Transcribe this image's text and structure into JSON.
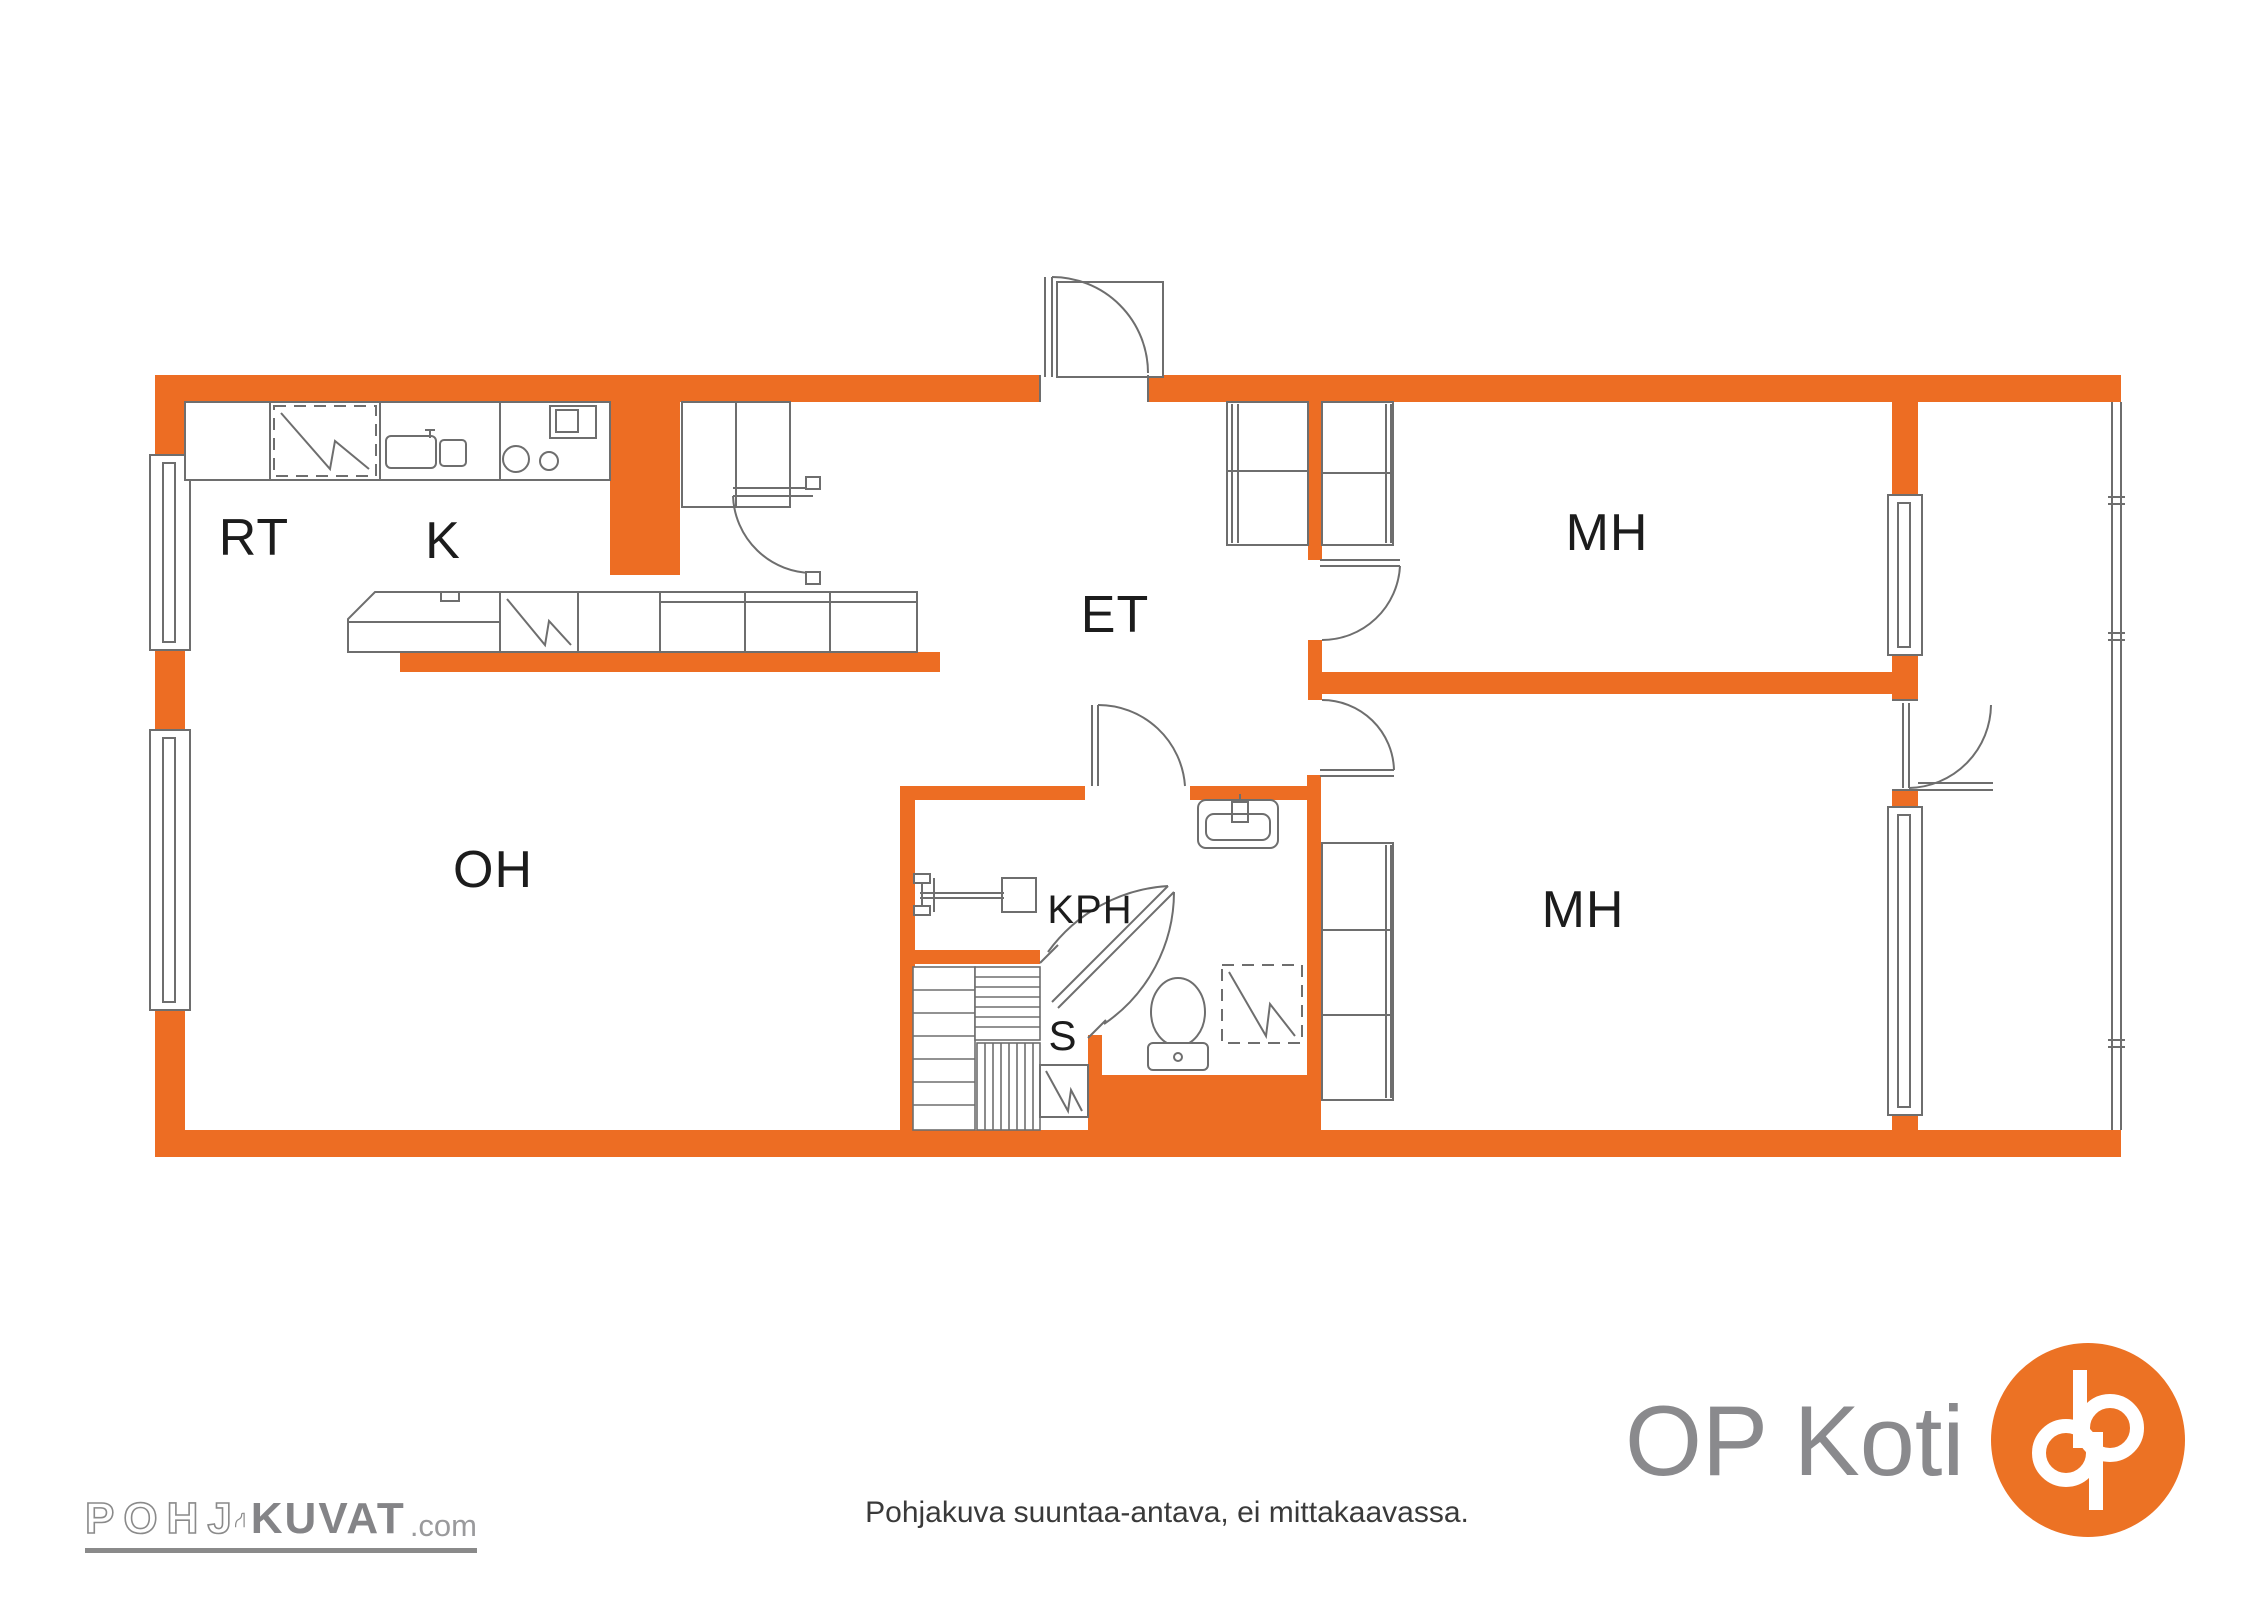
{
  "plan": {
    "rooms": {
      "rt": "RT",
      "k": "K",
      "et": "ET",
      "kph": "KPH",
      "s": "S",
      "mh_top": "MH",
      "mh_bottom": "MH",
      "oh": "OH"
    }
  },
  "fixtures": {
    "refrigerator-icon": "dashed box with zigzag",
    "kitchen-sink-icon": "double bowl",
    "cooktop-icon": "two burner circles",
    "oven-icon": "square with inner square",
    "dishwasher-icon": "zigzag cell in island",
    "wash-basin-icon": "rounded basin with tap",
    "toilet-icon": "bowl and cistern",
    "washing-machine-icon": "dashed box with zigzag",
    "shower-icon": "valve arm and head",
    "sauna-stove-icon": "box with zigzag",
    "sauna-benches": "slatted platforms",
    "window": "double frame lines",
    "door": "leaf with quarter arc"
  },
  "footer": {
    "watermark": {
      "outline": "POHJ",
      "bold": "KUVAT",
      "suffix": ".com"
    },
    "disclaimer": "Pohjakuva suuntaa-antava, ei mittakaavassa.",
    "brand": "OP Koti"
  },
  "colors": {
    "wall": "#ED6D23",
    "line": "#6E6E6E",
    "label": "#1C1C1C",
    "brand-grey": "#8A8A8D",
    "brand-orange": "#EC7224",
    "disclaimer": "#3A3A3A"
  }
}
